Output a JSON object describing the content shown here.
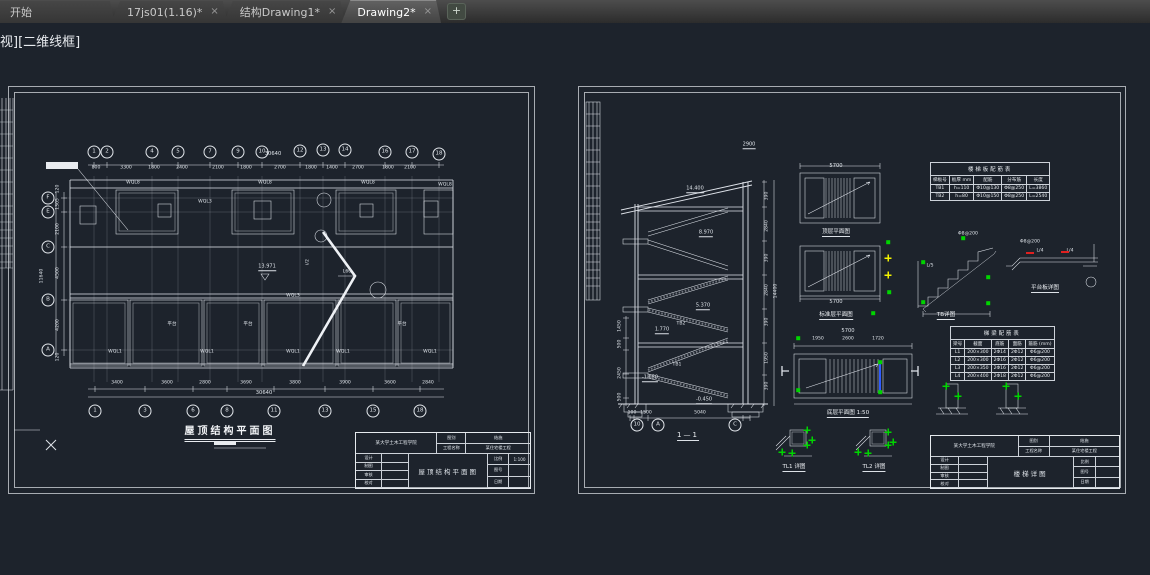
{
  "app": {
    "tabs": [
      {
        "label": "开始",
        "close": "",
        "cls": "start"
      },
      {
        "label": "17js01(1.16)*",
        "close": "×"
      },
      {
        "label": "结构Drawing1*",
        "close": "×"
      },
      {
        "label": "Drawing2*",
        "close": "×",
        "cls": "active"
      }
    ],
    "new_tab_glyph": "+",
    "viewport_label": "视][二维线框]"
  },
  "colors": {
    "canvas_bg": "#1d232c",
    "line": "#dfe3ea",
    "grip_green": "#00d400",
    "grip_yellow": "#f2f200",
    "selected_blue": "#2f5cff",
    "marker_red": "#e02020"
  },
  "left_sheet": {
    "title": "屋顶结构平面图",
    "top_total": "30640",
    "bottom_total": "30640",
    "left_total": "11640",
    "top_bubbles": [
      {
        "t": "1",
        "x": 86,
        "y": 66
      },
      {
        "t": "2",
        "x": 99,
        "y": 66
      },
      {
        "t": "4",
        "x": 144,
        "y": 66
      },
      {
        "t": "5",
        "x": 170,
        "y": 66
      },
      {
        "t": "7",
        "x": 202,
        "y": 66
      },
      {
        "t": "9",
        "x": 230,
        "y": 66
      },
      {
        "t": "10",
        "x": 254,
        "y": 66
      },
      {
        "t": "12",
        "x": 292,
        "y": 65
      },
      {
        "t": "13",
        "x": 315,
        "y": 64
      },
      {
        "t": "14",
        "x": 337,
        "y": 64
      },
      {
        "t": "16",
        "x": 377,
        "y": 66
      },
      {
        "t": "17",
        "x": 404,
        "y": 66
      },
      {
        "t": "18",
        "x": 431,
        "y": 68
      }
    ],
    "top_dims": [
      {
        "t": "800",
        "x": 88,
        "y": 82
      },
      {
        "t": "3300",
        "x": 118,
        "y": 82
      },
      {
        "t": "1800",
        "x": 146,
        "y": 82
      },
      {
        "t": "2400",
        "x": 174,
        "y": 82
      },
      {
        "t": "2100",
        "x": 210,
        "y": 82
      },
      {
        "t": "1800",
        "x": 238,
        "y": 82
      },
      {
        "t": "2700",
        "x": 272,
        "y": 82
      },
      {
        "t": "1800",
        "x": 303,
        "y": 82
      },
      {
        "t": "1400",
        "x": 324,
        "y": 82
      },
      {
        "t": "2700",
        "x": 350,
        "y": 82
      },
      {
        "t": "1800",
        "x": 380,
        "y": 82
      },
      {
        "t": "2100",
        "x": 402,
        "y": 82
      }
    ],
    "left_bubbles": [
      {
        "t": "F",
        "x": 40,
        "y": 112
      },
      {
        "t": "E",
        "x": 40,
        "y": 126
      },
      {
        "t": "C",
        "x": 40,
        "y": 161
      },
      {
        "t": "B",
        "x": 40,
        "y": 214
      },
      {
        "t": "A",
        "x": 40,
        "y": 264
      }
    ],
    "left_dims": [
      {
        "t": "120",
        "x": 50,
        "y": 103,
        "cls": "rot"
      },
      {
        "t": "1305",
        "x": 50,
        "y": 118,
        "cls": "rot"
      },
      {
        "t": "2100",
        "x": 50,
        "y": 143,
        "cls": "rot"
      },
      {
        "t": "4500",
        "x": 50,
        "y": 187,
        "cls": "rot"
      },
      {
        "t": "4200",
        "x": 50,
        "y": 239,
        "cls": "rot"
      },
      {
        "t": "120",
        "x": 50,
        "y": 271,
        "cls": "rot"
      }
    ],
    "bottom_dims": [
      {
        "t": "3400",
        "x": 109,
        "y": 297
      },
      {
        "t": "3600",
        "x": 159,
        "y": 297
      },
      {
        "t": "2800",
        "x": 197,
        "y": 297
      },
      {
        "t": "3690",
        "x": 238,
        "y": 297
      },
      {
        "t": "3800",
        "x": 287,
        "y": 297
      },
      {
        "t": "3900",
        "x": 337,
        "y": 297
      },
      {
        "t": "3600",
        "x": 382,
        "y": 297
      },
      {
        "t": "2840",
        "x": 420,
        "y": 297
      }
    ],
    "bottom_bubbles": [
      {
        "t": "1",
        "x": 87,
        "y": 325
      },
      {
        "t": "3",
        "x": 137,
        "y": 325
      },
      {
        "t": "6",
        "x": 185,
        "y": 325
      },
      {
        "t": "8",
        "x": 219,
        "y": 325
      },
      {
        "t": "11",
        "x": 266,
        "y": 325
      },
      {
        "t": "13",
        "x": 317,
        "y": 325
      },
      {
        "t": "15",
        "x": 365,
        "y": 325
      },
      {
        "t": "18",
        "x": 412,
        "y": 325
      }
    ],
    "plan_labels": [
      {
        "t": "WQL8",
        "x": 125,
        "y": 97
      },
      {
        "t": "WQL8",
        "x": 257,
        "y": 97
      },
      {
        "t": "WQL8",
        "x": 360,
        "y": 97
      },
      {
        "t": "WQL8",
        "x": 437,
        "y": 99
      },
      {
        "t": "WQL3",
        "x": 197,
        "y": 116
      },
      {
        "t": "WQL3",
        "x": 285,
        "y": 210
      },
      {
        "t": "WQL1",
        "x": 107,
        "y": 266
      },
      {
        "t": "WQL1",
        "x": 199,
        "y": 266
      },
      {
        "t": "WQL1",
        "x": 285,
        "y": 266
      },
      {
        "t": "WQL1",
        "x": 335,
        "y": 266
      },
      {
        "t": "WQL1",
        "x": 422,
        "y": 266
      },
      {
        "t": "平台",
        "x": 164,
        "y": 238
      },
      {
        "t": "平台",
        "x": 240,
        "y": 238
      },
      {
        "t": "平台",
        "x": 394,
        "y": 238
      },
      {
        "t": "13.971",
        "x": 259,
        "y": 181,
        "cls": "lvl"
      },
      {
        "t": "L60",
        "x": 339,
        "y": 186
      },
      {
        "t": "i/2",
        "x": 300,
        "y": 176,
        "cls": "rot"
      }
    ],
    "titleblock": {
      "org": "某大学土木工程学院",
      "category_label": "图别",
      "category": "结施",
      "project_label": "工程名称",
      "project": "某住宅楼工程",
      "name": "屋顶结构平面图",
      "design": "设计",
      "draw": "制图",
      "review": "审核",
      "check": "校对",
      "scale_label": "比例",
      "scale": "1:100",
      "no_label": "图号",
      "no_val": "",
      "date_label": "日期",
      "date_val": ""
    }
  },
  "right_sheet": {
    "section_label": "1—1",
    "flags": [
      {
        "t": "2900",
        "x": 171,
        "y": 59,
        "cls": "lvl"
      },
      {
        "t": "14.400",
        "x": 117,
        "y": 103,
        "cls": "lvl"
      },
      {
        "t": "8.970",
        "x": 128,
        "y": 147,
        "cls": "lvl"
      },
      {
        "t": "5.370",
        "x": 125,
        "y": 220,
        "cls": "lvl"
      },
      {
        "t": "1.770",
        "x": 84,
        "y": 244,
        "cls": "lvl"
      },
      {
        "t": "-1.050",
        "x": 72,
        "y": 292,
        "cls": "lvl"
      },
      {
        "t": "-0.450",
        "x": 126,
        "y": 314,
        "cls": "lvl"
      }
    ],
    "flight_labels": [
      {
        "t": "TB2",
        "x": 103,
        "y": 238
      },
      {
        "t": "TB1",
        "x": 99,
        "y": 279
      }
    ],
    "dims_left": [
      {
        "t": "1450",
        "x": 42,
        "y": 240,
        "cls": "rot"
      },
      {
        "t": "500",
        "x": 42,
        "y": 258,
        "cls": "rot"
      },
      {
        "t": "2450",
        "x": 42,
        "y": 287,
        "cls": "rot"
      },
      {
        "t": "500",
        "x": 42,
        "y": 311,
        "cls": "rot"
      }
    ],
    "dims_right": [
      {
        "t": "390",
        "x": 189,
        "y": 110,
        "cls": "rot"
      },
      {
        "t": "2840",
        "x": 189,
        "y": 140,
        "cls": "rot"
      },
      {
        "t": "390",
        "x": 189,
        "y": 172,
        "cls": "rot"
      },
      {
        "t": "2840",
        "x": 189,
        "y": 204,
        "cls": "rot"
      },
      {
        "t": "390",
        "x": 189,
        "y": 236,
        "cls": "rot"
      },
      {
        "t": "1950",
        "x": 189,
        "y": 272,
        "cls": "rot"
      },
      {
        "t": "390",
        "x": 189,
        "y": 300,
        "cls": "rot"
      },
      {
        "t": "14400",
        "x": 198,
        "y": 205,
        "cls": "rot"
      }
    ],
    "dims_bottom": [
      {
        "t": "100",
        "x": 54,
        "y": 327
      },
      {
        "t": "1500",
        "x": 68,
        "y": 327
      },
      {
        "t": "5040",
        "x": 122,
        "y": 327
      }
    ],
    "bubbles": [
      {
        "t": "10",
        "x": 59,
        "y": 339
      },
      {
        "t": "A",
        "x": 80,
        "y": 339
      },
      {
        "t": "C",
        "x": 157,
        "y": 339
      }
    ],
    "plan_dims": [
      {
        "t": "5700",
        "x": 258,
        "y": 80,
        "cls": "big"
      },
      {
        "t": "5700",
        "x": 258,
        "y": 216,
        "cls": "big"
      },
      {
        "t": "5700",
        "x": 270,
        "y": 245,
        "cls": "big"
      },
      {
        "t": "1950",
        "x": 240,
        "y": 253
      },
      {
        "t": "2600",
        "x": 270,
        "y": 253
      },
      {
        "t": "1720",
        "x": 300,
        "y": 253
      }
    ],
    "plan_captions": [
      {
        "t": "顶层平面图",
        "x": 258,
        "y": 141
      },
      {
        "t": "标准层平面图",
        "x": 258,
        "y": 224
      },
      {
        "t": "底层平面图 1:50",
        "x": 270,
        "y": 322
      }
    ],
    "detail_captions": [
      {
        "t": "TB详图",
        "x": 368,
        "y": 224
      },
      {
        "t": "平台板详图",
        "x": 467,
        "y": 197
      },
      {
        "t": "TL1 详图",
        "x": 216,
        "y": 376
      },
      {
        "t": "TL2 详图",
        "x": 296,
        "y": 376
      }
    ],
    "rebar_labels": [
      {
        "t": "Φ8@200",
        "x": 390,
        "y": 148
      },
      {
        "t": "L/5",
        "x": 352,
        "y": 180
      },
      {
        "t": "Φ8@200",
        "x": 452,
        "y": 156
      },
      {
        "t": "L/4",
        "x": 462,
        "y": 165
      },
      {
        "t": "L/4",
        "x": 492,
        "y": 165
      }
    ],
    "marks": [
      {
        "cls": "ycross",
        "x": 310,
        "y": 172
      },
      {
        "cls": "ycross",
        "x": 310,
        "y": 189
      },
      {
        "cls": "gdot",
        "x": 311,
        "y": 206
      },
      {
        "cls": "gdot",
        "x": 295,
        "y": 227
      },
      {
        "cls": "gdot",
        "x": 310,
        "y": 156
      },
      {
        "cls": "gdot",
        "x": 220,
        "y": 252
      },
      {
        "cls": "gdot",
        "x": 220,
        "y": 304
      },
      {
        "cls": "gdot",
        "x": 302,
        "y": 276
      },
      {
        "cls": "gdot",
        "x": 302,
        "y": 306
      },
      {
        "cls": "gdot",
        "x": 345,
        "y": 176
      },
      {
        "cls": "gdot",
        "x": 345,
        "y": 216
      },
      {
        "cls": "gdot",
        "x": 410,
        "y": 191
      },
      {
        "cls": "gdot",
        "x": 410,
        "y": 217
      },
      {
        "cls": "gdot",
        "x": 385,
        "y": 152
      },
      {
        "cls": "rbar",
        "x": 452,
        "y": 167
      },
      {
        "cls": "rbar",
        "x": 487,
        "y": 166
      },
      {
        "cls": "gcross",
        "x": 229,
        "y": 344
      },
      {
        "cls": "gcross",
        "x": 234,
        "y": 354
      },
      {
        "cls": "gcross",
        "x": 229,
        "y": 359
      },
      {
        "cls": "gcross",
        "x": 204,
        "y": 366
      },
      {
        "cls": "gcross",
        "x": 214,
        "y": 367
      },
      {
        "cls": "gcross",
        "x": 310,
        "y": 346
      },
      {
        "cls": "gcross",
        "x": 315,
        "y": 356
      },
      {
        "cls": "gcross",
        "x": 310,
        "y": 359
      },
      {
        "cls": "gcross",
        "x": 280,
        "y": 366
      },
      {
        "cls": "gcross",
        "x": 290,
        "y": 367
      },
      {
        "cls": "gcross",
        "x": 368,
        "y": 300
      },
      {
        "cls": "gcross",
        "x": 380,
        "y": 310
      },
      {
        "cls": "gcross",
        "x": 428,
        "y": 300
      },
      {
        "cls": "gcross",
        "x": 440,
        "y": 310
      }
    ],
    "table1": {
      "title": "楼梯板配筋表",
      "headers": [
        "梯板号",
        "板厚 mm",
        "配筋",
        "分布筋",
        "长度"
      ],
      "rows": [
        [
          "TB1",
          "h=110",
          "Φ10@130",
          "Φ8@250",
          "L=3860"
        ],
        [
          "TB2",
          "h=80",
          "Φ10@150",
          "Φ8@250",
          "L=2540"
        ]
      ]
    },
    "table2": {
      "title": "梯梁配筋表",
      "headers": [
        "梁号",
        "截面",
        "底筋",
        "面筋",
        "箍筋 (mm)"
      ],
      "rows": [
        [
          "L1",
          "200×300",
          "2Φ14",
          "2Φ12",
          "Φ6@200"
        ],
        [
          "L2",
          "200×300",
          "2Φ16",
          "2Φ12",
          "Φ6@200"
        ],
        [
          "L3",
          "200×350",
          "2Φ16",
          "2Φ12",
          "Φ6@200"
        ],
        [
          "L4",
          "200×400",
          "2Φ18",
          "2Φ12",
          "Φ6@200"
        ]
      ]
    },
    "titleblock": {
      "org": "某大学土木工程学院",
      "category_label": "图别",
      "category": "结施",
      "project_label": "工程名称",
      "project": "某住宅楼工程",
      "name": "楼梯详图",
      "design": "设计",
      "draw": "制图",
      "review": "审核",
      "check": "校对",
      "scale_label": "比例",
      "scale": "",
      "no_label": "图号",
      "no_val": "",
      "date_label": "日期",
      "date_val": ""
    }
  }
}
